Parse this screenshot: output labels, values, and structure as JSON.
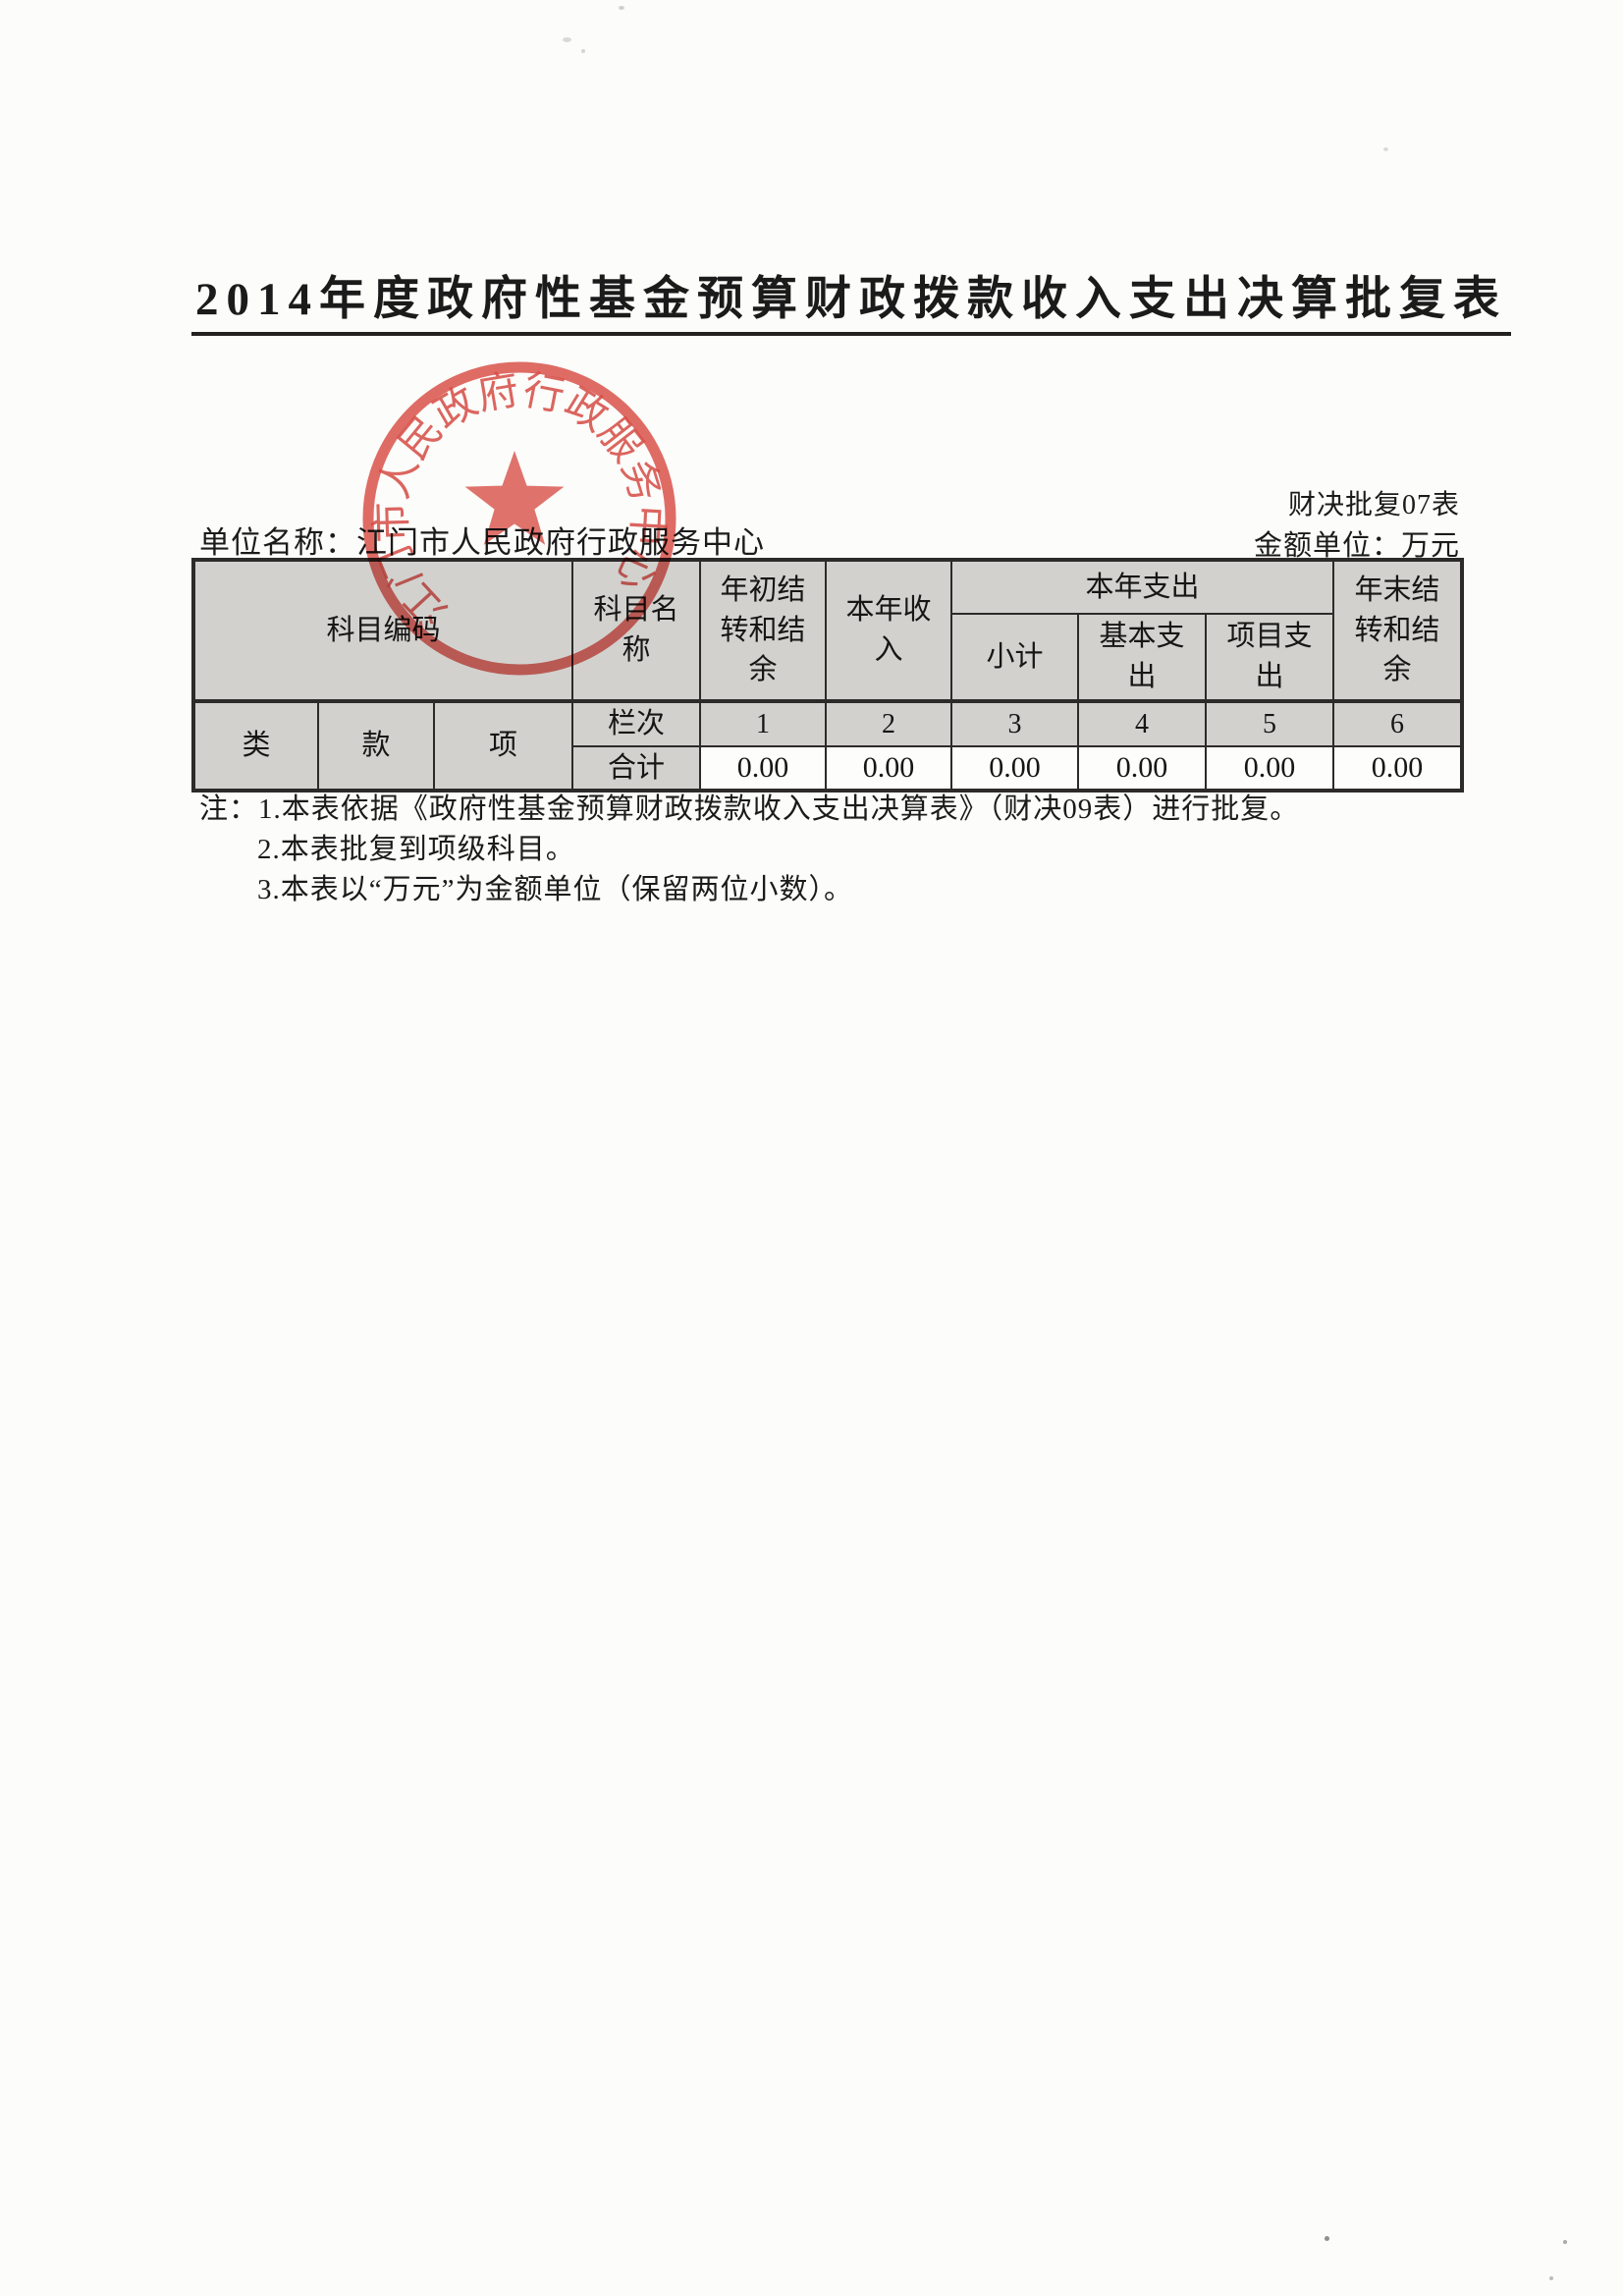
{
  "document": {
    "title": "2014年度政府性基金预算财政拨款收入支出决算批复表",
    "form_code": "财决批复07表",
    "unit_label": "单位名称：",
    "unit_name": "江门市人民政府行政服务中心",
    "amount_unit": "金额单位：万元"
  },
  "stamp": {
    "text": "江门市人民政府行政服务中心",
    "color": "#d8423b"
  },
  "table": {
    "header": {
      "subject_code": "科目编码",
      "subject_name": "科目名称",
      "begin_year_balance": "年初结转和结余",
      "current_year_income": "本年收入",
      "current_year_expense": "本年支出",
      "subtotal": "小计",
      "basic_expense": "基本支出",
      "project_expense": "项目支出",
      "end_year_balance": "年末结转和结余",
      "class": "类",
      "clause": "款",
      "item": "项",
      "column_index_label": "栏次",
      "total_label": "合计"
    },
    "columns": [
      "1",
      "2",
      "3",
      "4",
      "5",
      "6"
    ],
    "totals": [
      "0.00",
      "0.00",
      "0.00",
      "0.00",
      "0.00",
      "0.00"
    ]
  },
  "notes": {
    "prefix": "注：",
    "items": [
      "1.本表依据《政府性基金预算财政拨款收入支出决算表》（财决09表）进行批复。",
      "2.本表批复到项级科目。",
      "3.本表以“万元”为金额单位（保留两位小数）。"
    ]
  },
  "colors": {
    "header_bg": "#d2d1ce",
    "value_bg": "#fdfdfc",
    "stamp_red": "#d8423b",
    "border": "#2c2b29",
    "paper": "#fcfcfa"
  }
}
